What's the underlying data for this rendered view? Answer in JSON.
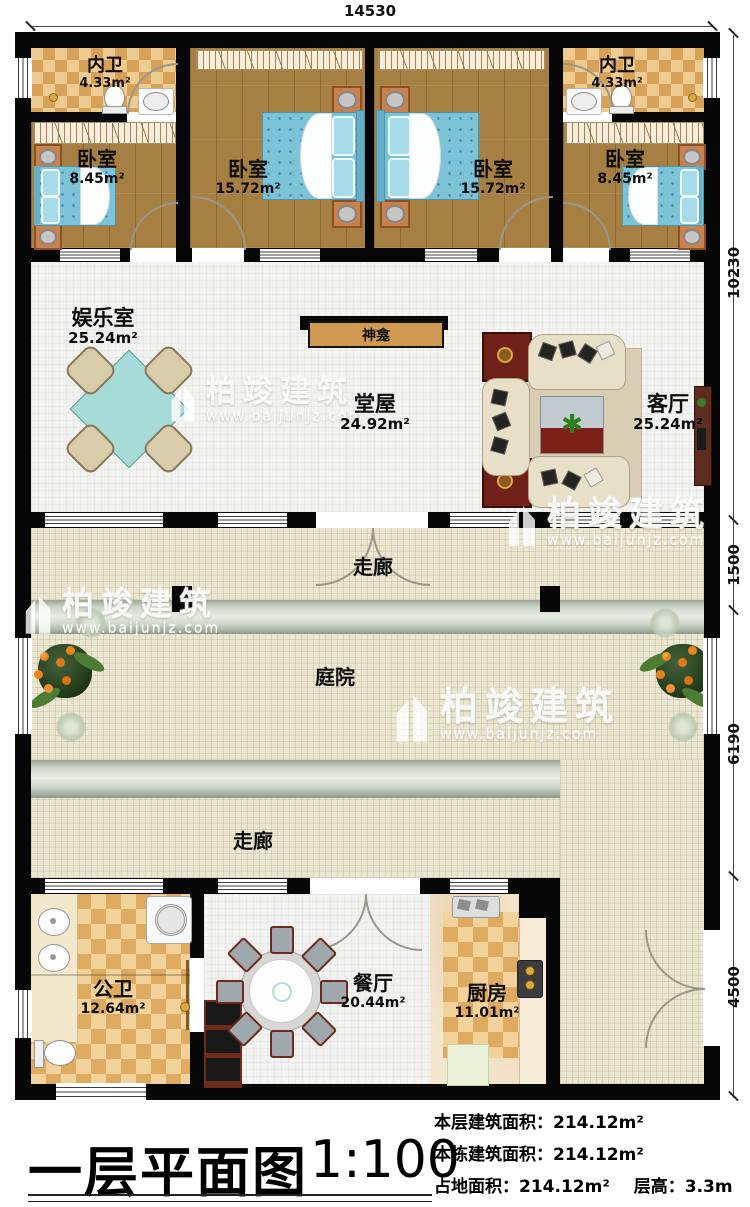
{
  "watermark": {
    "brand": "柏竣建筑",
    "url": "www.baijunjz.com"
  },
  "dimensions": {
    "top": "14530",
    "right": [
      "10230",
      "1500",
      "6190",
      "4500"
    ]
  },
  "rooms": {
    "bath_left": {
      "name": "内卫",
      "area": "4.33m²"
    },
    "bath_right": {
      "name": "内卫",
      "area": "4.33m²"
    },
    "bedroom_small_left": {
      "name": "卧室",
      "area": "8.45m²"
    },
    "bedroom_big_left": {
      "name": "卧室",
      "area": "15.72m²"
    },
    "bedroom_big_right": {
      "name": "卧室",
      "area": "15.72m²"
    },
    "bedroom_small_right": {
      "name": "卧室",
      "area": "8.45m²"
    },
    "entertainment": {
      "name": "娱乐室",
      "area": "25.24m²"
    },
    "shrine": {
      "name": "神龛"
    },
    "hall": {
      "name": "堂屋",
      "area": "24.92m²"
    },
    "living": {
      "name": "客厅",
      "area": "25.24m²"
    },
    "corridor_top": {
      "name": "走廊"
    },
    "courtyard": {
      "name": "庭院"
    },
    "corridor_bottom": {
      "name": "走廊"
    },
    "public_bath": {
      "name": "公卫",
      "area": "12.64m²"
    },
    "dining": {
      "name": "餐厅",
      "area": "20.44m²"
    },
    "kitchen": {
      "name": "厨房",
      "area": "11.01m²"
    }
  },
  "title_block": {
    "title": "一层平面图",
    "scale": "1:100",
    "stat1_label": "本层建筑面积：",
    "stat1_value": "214.12m²",
    "stat2_label": "本栋建筑面积：",
    "stat2_value": "214.12m²",
    "stat3_label": "占地面积：",
    "stat3_value": "214.12m²",
    "stat4_label": "层高：",
    "stat4_value": "3.3m"
  }
}
